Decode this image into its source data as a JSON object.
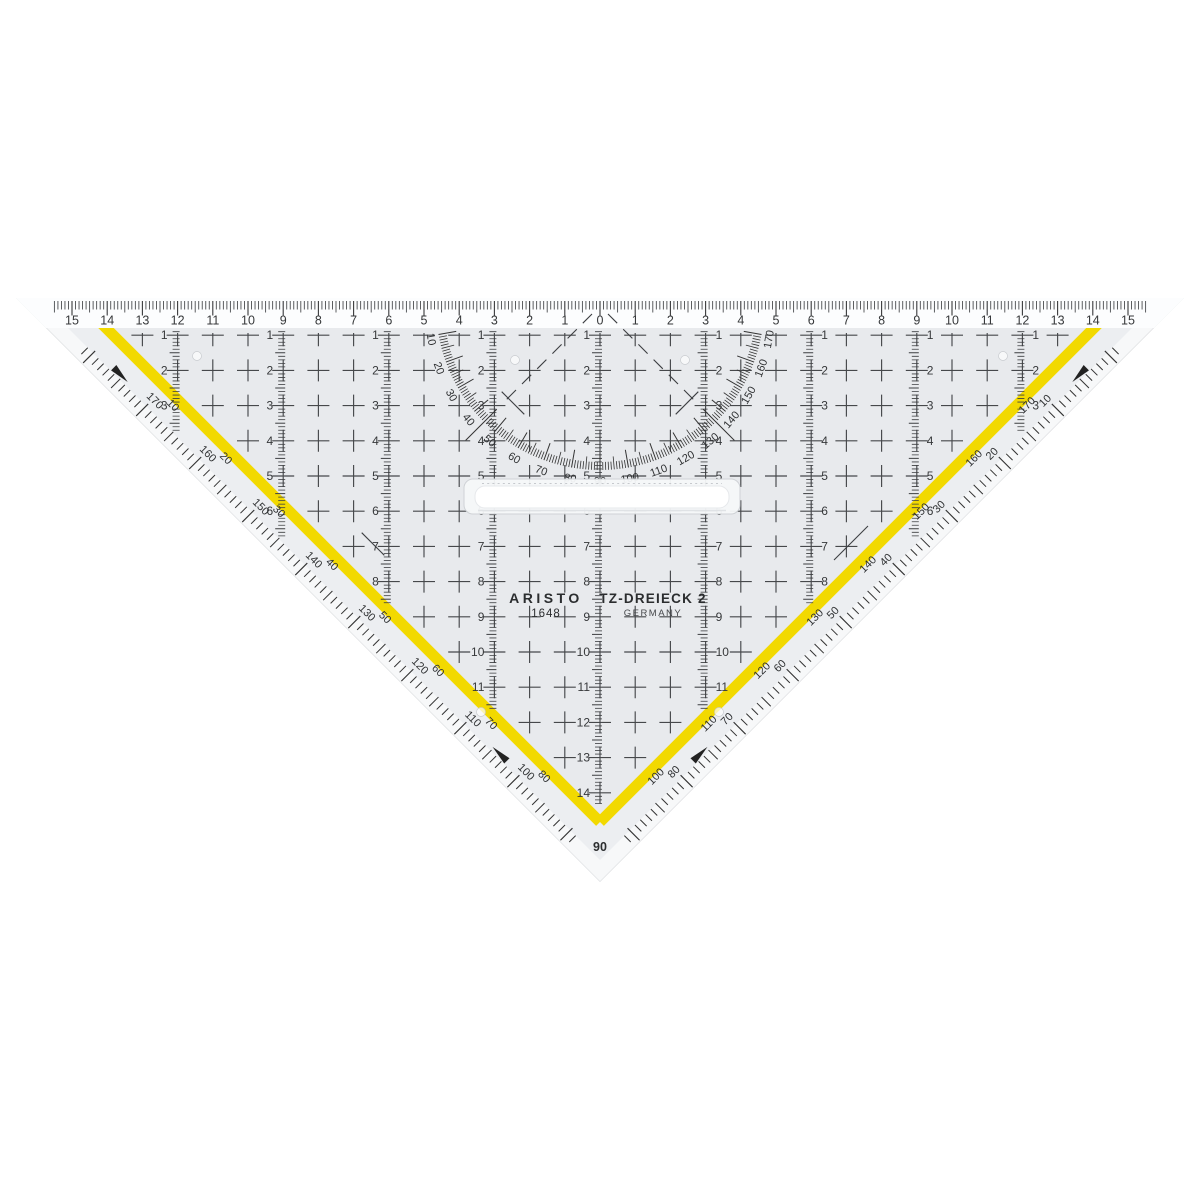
{
  "product": {
    "brand": "ARISTO",
    "model": "1648",
    "name": "TZ-DREIECK 2",
    "country": "GERMANY"
  },
  "colors": {
    "stripe": "#f2d900",
    "body": "#e8eaed",
    "margin": "#eceef1",
    "bevel": "#f7f8f9",
    "strip": "#fcfdfe",
    "ink": "#333333"
  },
  "scales": {
    "cm_top": [
      "15",
      "14",
      "13",
      "12",
      "11",
      "10",
      "9",
      "8",
      "7",
      "6",
      "5",
      "4",
      "3",
      "2",
      "1",
      "0",
      "1",
      "2",
      "3",
      "4",
      "5",
      "6",
      "7",
      "8",
      "9",
      "10",
      "11",
      "12",
      "13",
      "14",
      "15"
    ],
    "rows": [
      "1",
      "2",
      "3",
      "4",
      "5",
      "6",
      "7",
      "8",
      "9",
      "10",
      "11",
      "12",
      "13",
      "14"
    ],
    "protractor_degrees": [
      "10",
      "20",
      "30",
      "40",
      "50",
      "60",
      "70",
      "80",
      "90",
      "100",
      "110",
      "120",
      "130",
      "140",
      "150",
      "160",
      "170"
    ],
    "edge_left_outer": [
      "170",
      "160",
      "150",
      "140",
      "130",
      "120",
      "110",
      "100"
    ],
    "edge_left_inner": [
      "10",
      "20",
      "30",
      "40",
      "50",
      "60",
      "70",
      "80"
    ],
    "edge_right_outer": [
      "10",
      "20",
      "30",
      "40",
      "50",
      "60",
      "70",
      "80"
    ],
    "edge_right_inner": [
      "170",
      "160",
      "150",
      "140",
      "130",
      "120",
      "110",
      "100"
    ],
    "vertex_degree": "90"
  }
}
